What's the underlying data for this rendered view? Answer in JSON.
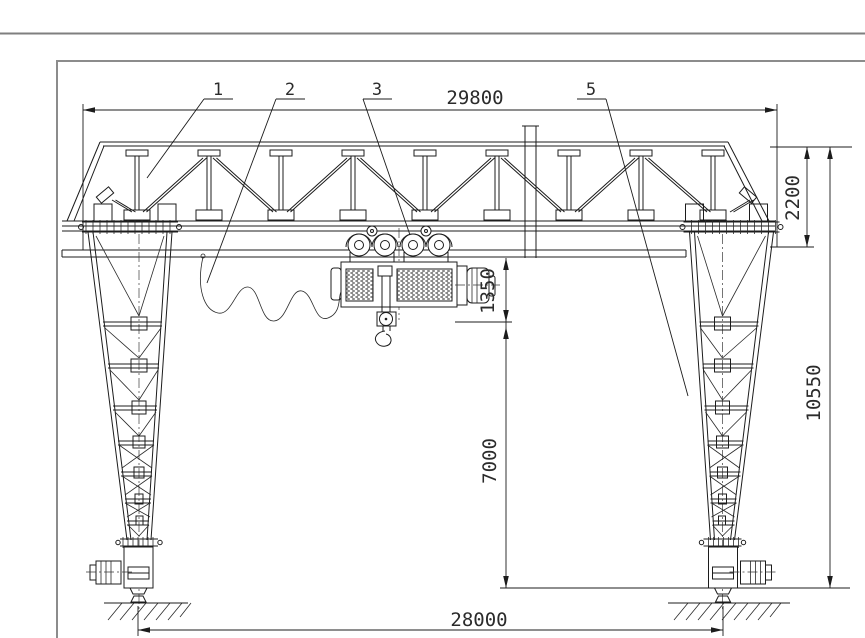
{
  "drawing": {
    "kind": "gantry-crane-general-arrangement",
    "dimensions": {
      "overall_length": {
        "value": "29800"
      },
      "girder_depth": {
        "value": "2200"
      },
      "overall_height": {
        "value": "10550"
      },
      "hook_headroom": {
        "value": "1350"
      },
      "lifting_height": {
        "value": "7000"
      },
      "span": {
        "value": "28000"
      }
    },
    "part_labels": {
      "item1": "1",
      "item2": "2",
      "item3": "3",
      "item5": "5"
    },
    "colors": {
      "line": "#1c1c1c",
      "frame": "#8c8c8c",
      "background": "#ffffff"
    }
  }
}
